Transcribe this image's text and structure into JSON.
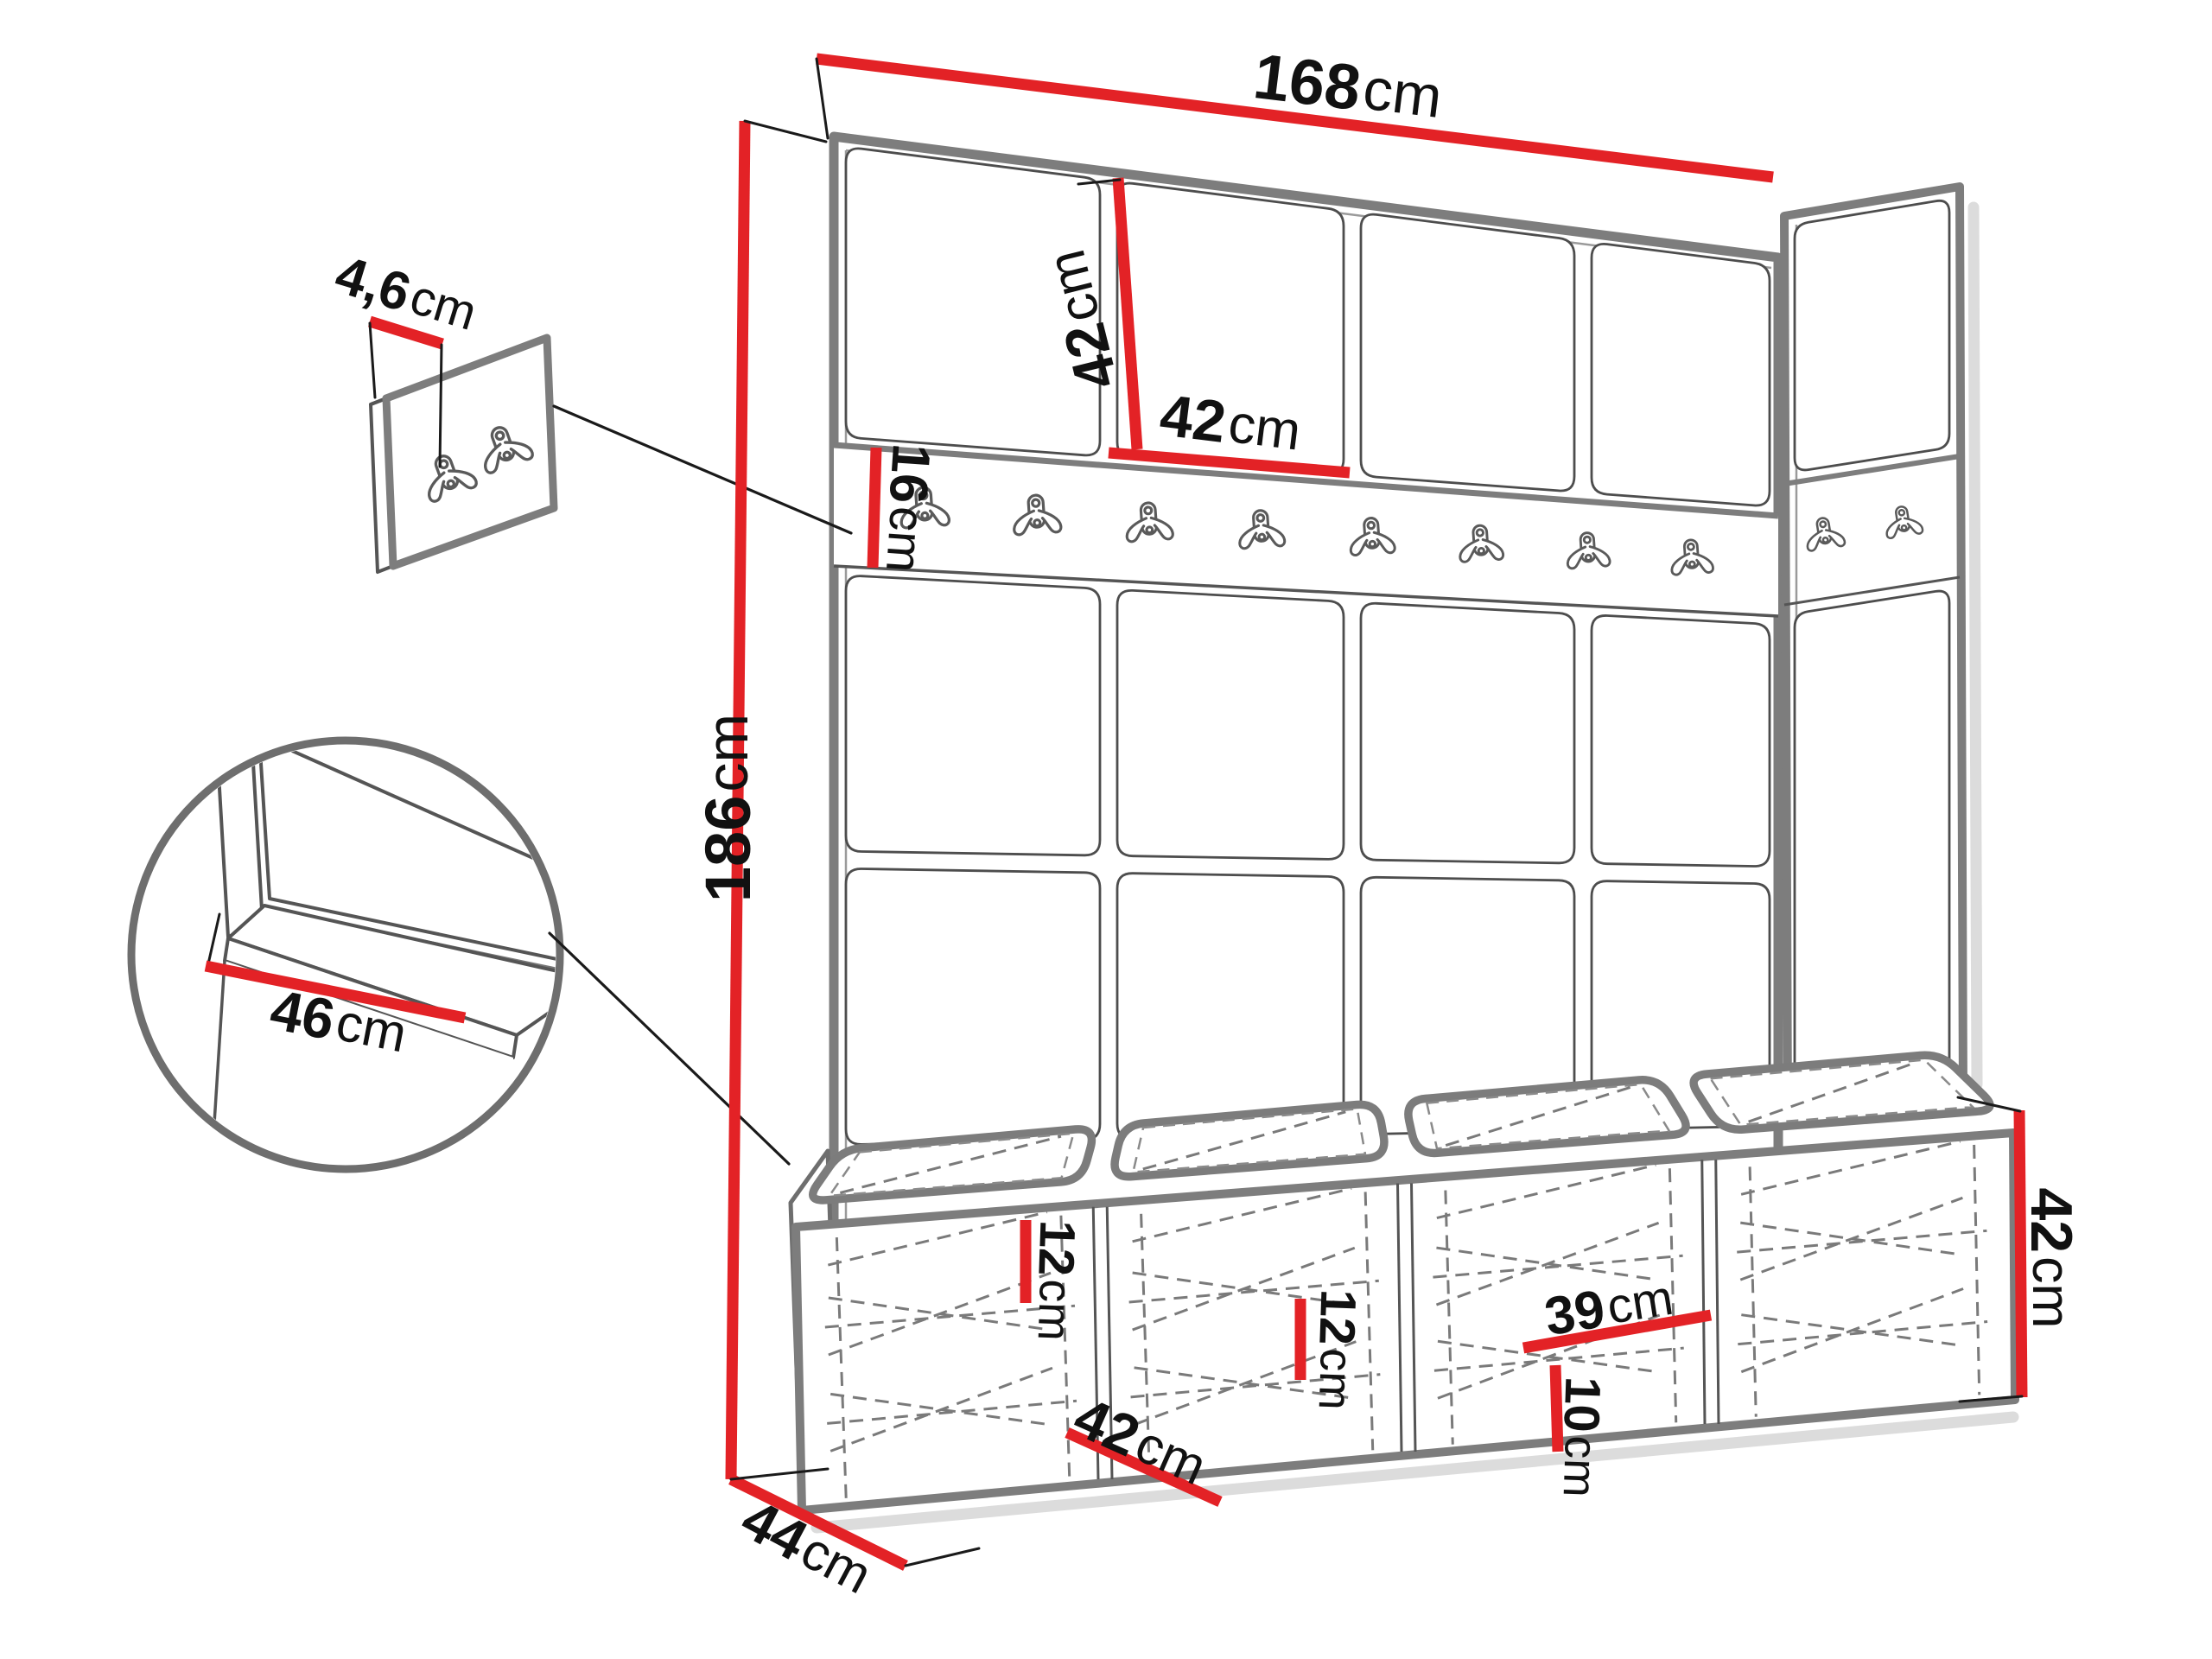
{
  "dims": {
    "width_top": {
      "value": "168",
      "unit": "cm"
    },
    "total_height": {
      "value": "186",
      "unit": "cm"
    },
    "panel_height": {
      "value": "42",
      "unit": "cm"
    },
    "panel_width": {
      "value": "42",
      "unit": "cm"
    },
    "rail_height": {
      "value": "16",
      "unit": "cm"
    },
    "hook_panel_thickness": {
      "value": "4,6",
      "unit": "cm"
    },
    "seat_depth": {
      "value": "46",
      "unit": "cm"
    },
    "unit_depth": {
      "value": "44",
      "unit": "cm"
    },
    "shelf_spacing_left": {
      "value": "12",
      "unit": "cm"
    },
    "cubby_width": {
      "value": "42",
      "unit": "cm"
    },
    "shelf_spacing_mid": {
      "value": "12",
      "unit": "cm"
    },
    "shelf_depth": {
      "value": "39",
      "unit": "cm"
    },
    "bottom_gap": {
      "value": "10",
      "unit": "cm"
    },
    "bench_height": {
      "value": "42",
      "unit": "cm"
    }
  },
  "colors": {
    "accent": "#e32226",
    "outline": "#7d7d7d",
    "thin_line": "#4d4d4d",
    "dash": "#7a7a7a",
    "shadow": "#dcdcdc",
    "text": "#111111"
  },
  "icons": {
    "coat_hook": "double-prong-coat-hook-icon"
  }
}
